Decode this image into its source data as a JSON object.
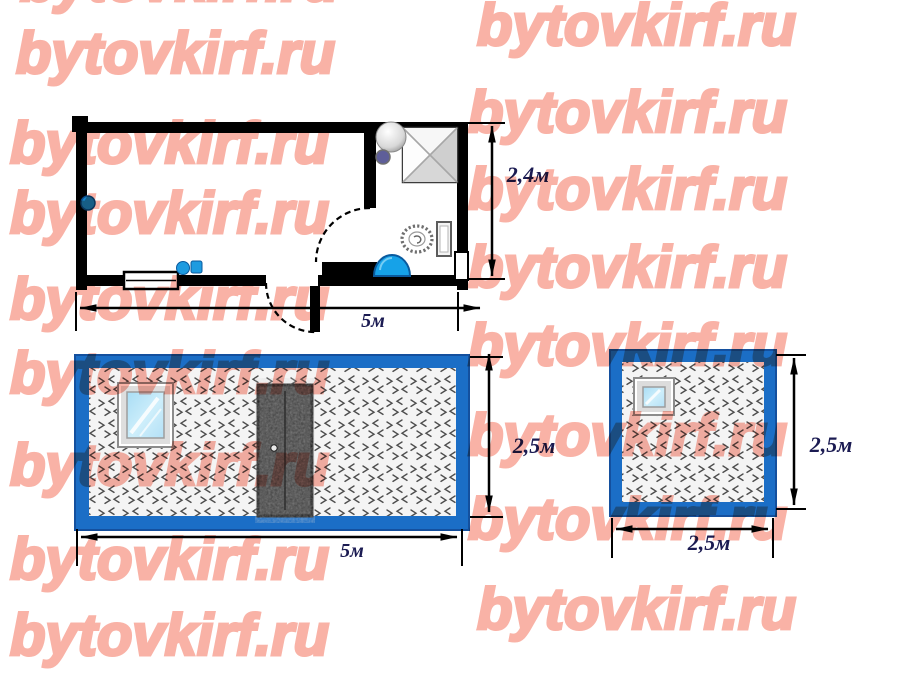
{
  "watermark": {
    "text": "bytovkirf.ru",
    "color": "#F9B2A6"
  },
  "floor_plan": {
    "title": "cabin-floor-plan",
    "width_label": "5м",
    "height_label": "2,4м"
  },
  "front_elevation": {
    "title": "cabin-front-elevation",
    "width_label": "5м",
    "height_label": "2,5м"
  },
  "side_elevation": {
    "title": "cabin-side-elevation",
    "width_label": "2,5м",
    "height_label": "2,5м"
  },
  "colors": {
    "frame_blue": "#1B6EC6",
    "fixture_blue": "#16A2E8",
    "dimension_text": "#1b1b52",
    "watermark_pink": "#F9B2A6"
  }
}
